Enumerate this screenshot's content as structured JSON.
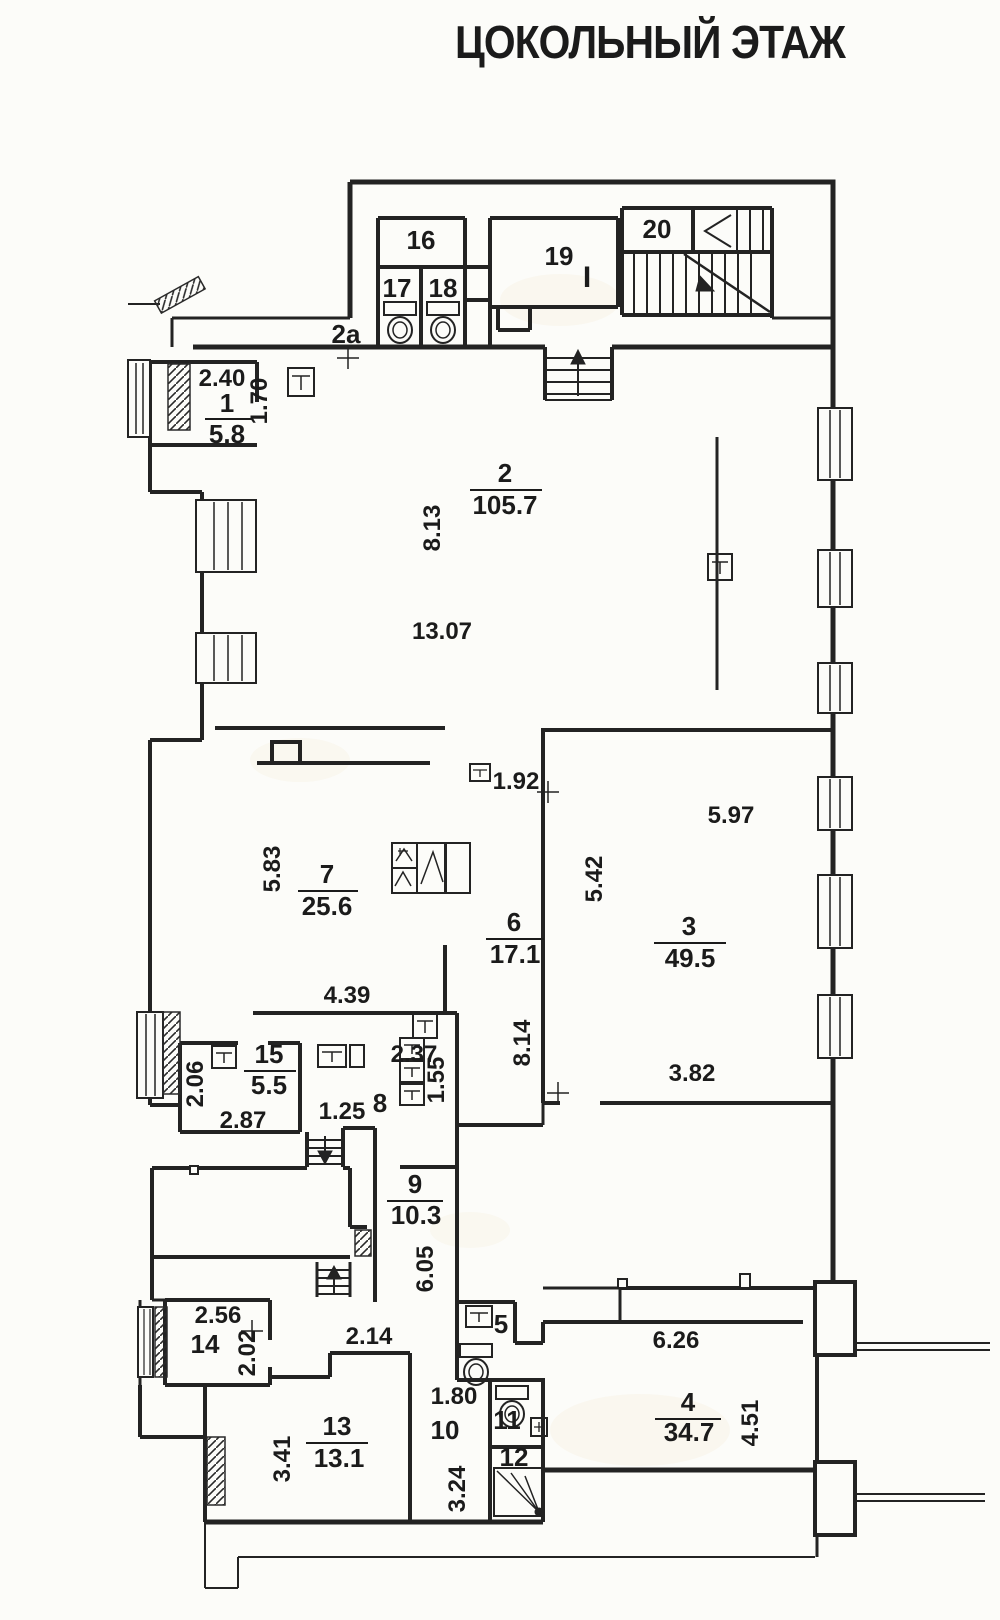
{
  "title": "ЦОКОЛЬНЫЙ ЭТАЖ",
  "section_marker": "I",
  "colors": {
    "ink": "#232323",
    "marker": "#cf3b22",
    "paper": "#fcfcf9"
  },
  "rooms": {
    "r1": {
      "num": "1",
      "area": "5.8"
    },
    "r2": {
      "num": "2",
      "area": "105.7"
    },
    "r3": {
      "num": "3",
      "area": "49.5"
    },
    "r4": {
      "num": "4",
      "area": "34.7"
    },
    "r6": {
      "num": "6",
      "area": "17.1"
    },
    "r7": {
      "num": "7",
      "area": "25.6"
    },
    "r9": {
      "num": "9",
      "area": "10.3"
    },
    "r13": {
      "num": "13",
      "area": "13.1"
    },
    "r15": {
      "num": "15",
      "area": "5.5"
    },
    "r2a": "2a",
    "r5": "5",
    "r8": "8",
    "r10": "10",
    "r11": "11",
    "r12": "12",
    "r14": "14",
    "r16": "16",
    "r17": "17",
    "r18": "18",
    "r19": "19",
    "r20": "20"
  },
  "dims": {
    "v240": "2.40",
    "v170": "1.70",
    "v813": "8.13",
    "v1307": "13.07",
    "v192": "1.92",
    "v583": "5.83",
    "v439": "4.39",
    "v542": "5.42",
    "v597": "5.97",
    "v814": "8.14",
    "v382": "3.82",
    "v206": "2.06",
    "v287": "2.87",
    "v125": "1.25",
    "v237": "2.37",
    "v155": "1.55",
    "v605": "6.05",
    "v256": "2.56",
    "v202": "2.02",
    "v214": "2.14",
    "v341": "3.41",
    "v180": "1.80",
    "v324": "3.24",
    "v626": "6.26",
    "v451": "4.51"
  }
}
